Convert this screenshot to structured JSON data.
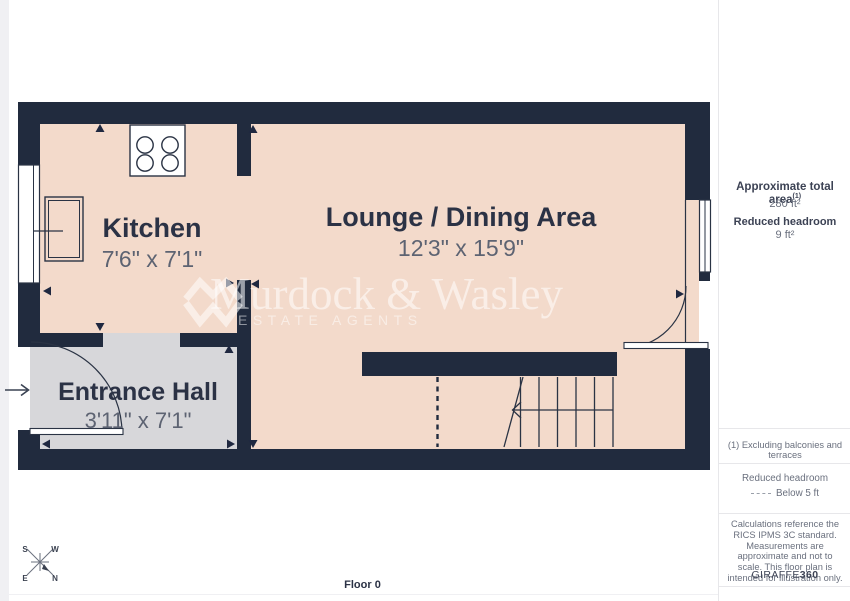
{
  "floor_plan": {
    "floor_label": "Floor 0",
    "rooms": [
      {
        "name": "Kitchen",
        "dimensions": "7'6\" x 7'1\""
      },
      {
        "name": "Lounge / Dining Area",
        "dimensions": "12'3\" x 15'9\""
      },
      {
        "name": "Entrance Hall",
        "dimensions": "3'11\" x 7'1\""
      }
    ],
    "compass": {
      "n": "N",
      "s": "S",
      "e": "E",
      "w": "W"
    }
  },
  "watermark": {
    "name": "Murdock & Wasley",
    "tagline": "ESTATE AGENTS"
  },
  "sidebar": {
    "total_area_label": "Approximate total area",
    "total_area_note_ref": "(1)",
    "total_area_value": "280 ft²",
    "reduced_headroom_label": "Reduced headroom",
    "reduced_headroom_value": "9 ft²",
    "footnote": "(1) Excluding balconies and terraces",
    "legend_title": "Reduced headroom",
    "legend_item": "Below 5 ft",
    "disclaimer": "Calculations reference the RICS IPMS 3C standard. Measurements are approximate and not to scale. This floor plan is intended for illustration only.",
    "brand": "GIRAFFE",
    "brand_suffix": "360"
  },
  "colors": {
    "wall": "#212b3e",
    "floor": "#f3dacb",
    "hall": "#d7d7da",
    "label": "#2b3245",
    "dim": "#5d6372"
  }
}
